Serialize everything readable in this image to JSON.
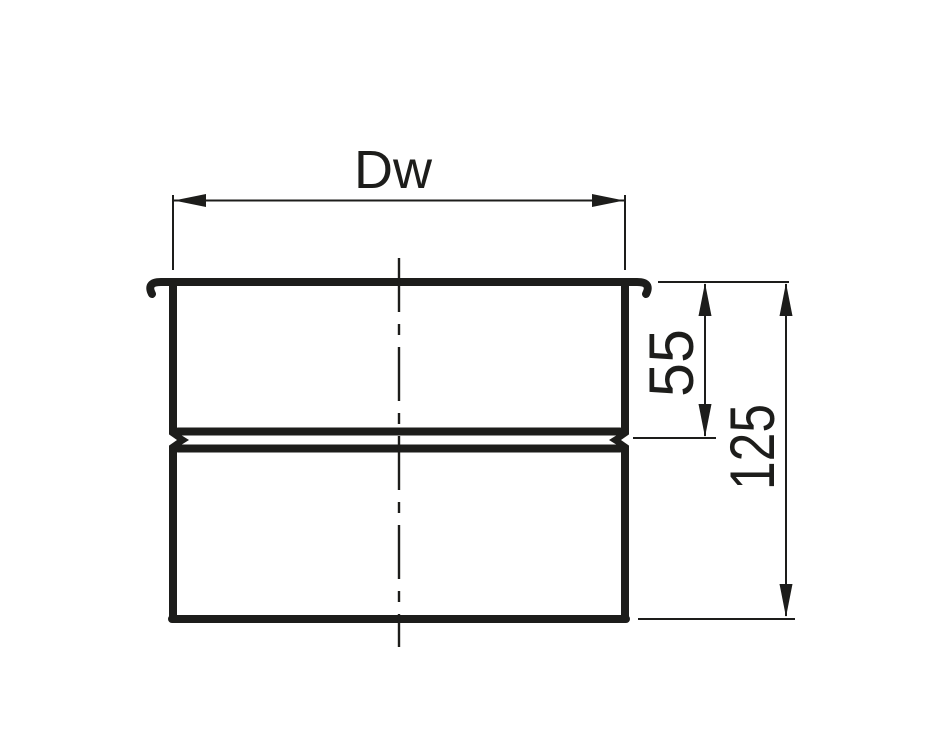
{
  "drawing": {
    "dimensions": {
      "width": {
        "label": "Dw"
      },
      "upper_height": {
        "label": "55"
      },
      "total_height": {
        "label": "125"
      }
    },
    "colors": {
      "ink": "#1d1d1b",
      "background": "#ffffff"
    }
  }
}
